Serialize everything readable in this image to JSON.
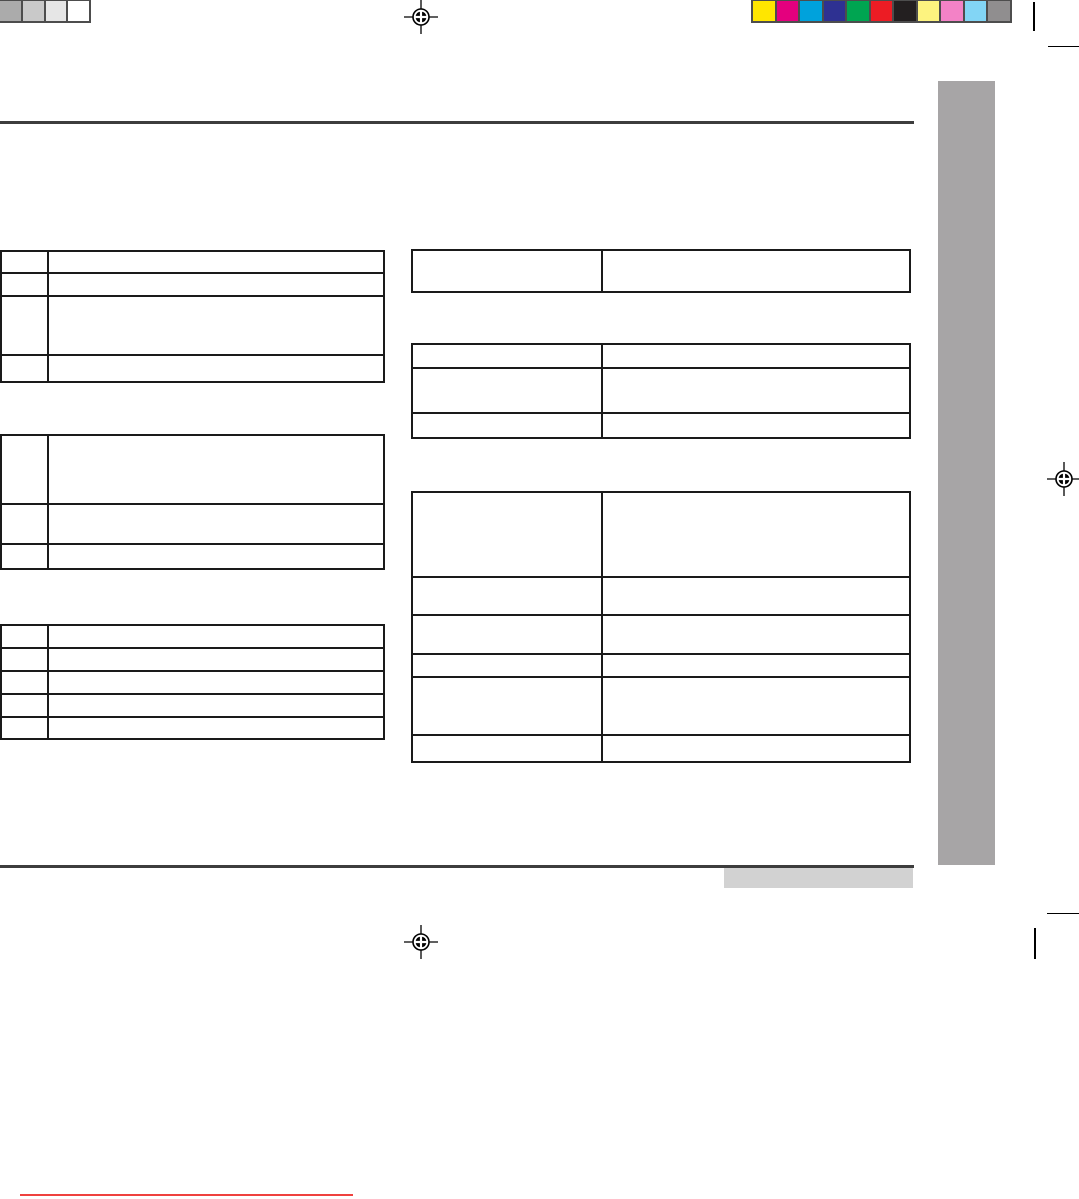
{
  "page": {
    "title": "",
    "description": "Blank print-proof document page (no visible text): crop marks, registration marks, calibration color bars, gray sidebar tab and empty specification tables",
    "background": "#ffffff"
  },
  "calibration": {
    "grayscale": [
      "#ababab",
      "#c9c9c9",
      "#e6e6e6",
      "#ffffff"
    ],
    "colors": [
      "#ffe600",
      "#e4007e",
      "#00a2dc",
      "#2e3192",
      "#00a551",
      "#ec1c24",
      "#231f20",
      "#fdf37f",
      "#f382c6",
      "#82d5f5",
      "#908e8f"
    ],
    "swatch_border_color": "#4d4d4d"
  },
  "accents": {
    "rule_color": "#3d3d3d",
    "sidebar_color": "#a7a5a6",
    "footer_box_color": "#d2d2d2",
    "red_line_color": "#ef413e",
    "table_border_color": "#1a1a1a",
    "mark_color": "#000000"
  },
  "tables": {
    "left": [
      {
        "name": "left-table-1",
        "columns": 2,
        "rows": 4,
        "cells": [
          [
            "",
            ""
          ],
          [
            "",
            ""
          ],
          [
            "",
            ""
          ],
          [
            "",
            ""
          ]
        ]
      },
      {
        "name": "left-table-2",
        "columns": 2,
        "rows": 3,
        "cells": [
          [
            "",
            ""
          ],
          [
            "",
            ""
          ],
          [
            "",
            ""
          ]
        ]
      },
      {
        "name": "left-table-3",
        "columns": 2,
        "rows": 5,
        "cells": [
          [
            "",
            ""
          ],
          [
            "",
            ""
          ],
          [
            "",
            ""
          ],
          [
            "",
            ""
          ],
          [
            "",
            ""
          ]
        ]
      }
    ],
    "right": [
      {
        "name": "right-table-1",
        "columns": 2,
        "rows": 1,
        "cells": [
          [
            "",
            ""
          ]
        ]
      },
      {
        "name": "right-table-2",
        "columns": 2,
        "rows": 3,
        "cells": [
          [
            "",
            ""
          ],
          [
            "",
            ""
          ],
          [
            "",
            ""
          ]
        ]
      },
      {
        "name": "right-table-3",
        "columns": 2,
        "rows": 6,
        "cells": [
          [
            "",
            ""
          ],
          [
            "",
            ""
          ],
          [
            "",
            ""
          ],
          [
            "",
            ""
          ],
          [
            "",
            ""
          ],
          [
            "",
            ""
          ]
        ]
      }
    ]
  }
}
